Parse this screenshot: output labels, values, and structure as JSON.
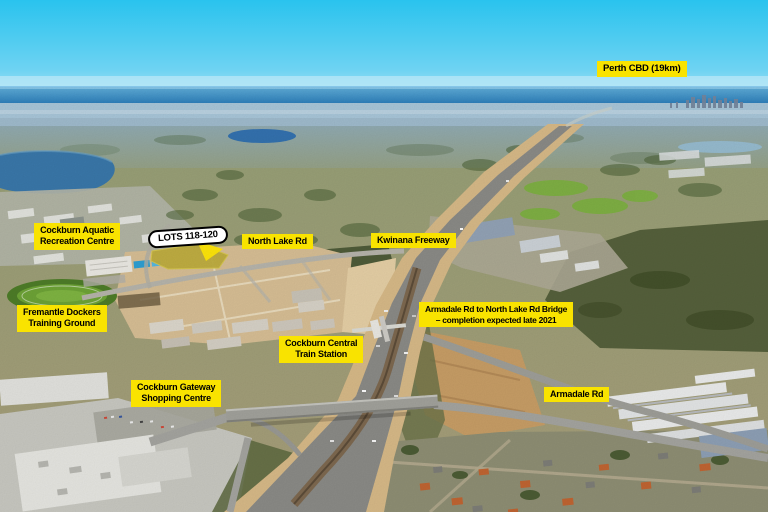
{
  "scene": {
    "description": "Aerial photograph over Cockburn Central and the Kwinana Freeway looking toward Perth CBD, with highlighted development lots",
    "colors": {
      "label_bg": "#F9E300",
      "label_text": "#000000",
      "lots_label_bg": "#FFFFFF",
      "lots_label_border": "#000000",
      "lot_highlight": "#BFAE3E",
      "pointer_arrow": "#FFE600",
      "sky": "#2AC4EE",
      "ocean": "#2E83C0"
    }
  },
  "labels": {
    "perth_cbd": "Perth CBD (19km)",
    "lots": "LOTS 118-120",
    "north_lake_rd": "North Lake Rd",
    "kwinana_freeway": "Kwinana Freeway",
    "aquatic": {
      "line1": "Cockburn Aquatic",
      "line2": "Recreation Centre"
    },
    "fremantle": {
      "line1": "Fremantle Dockers",
      "line2": "Training Ground"
    },
    "bridge": {
      "line1": "Armadale Rd to North Lake Rd Bridge",
      "line2": "– completion expected late 2021"
    },
    "station": {
      "line1": "Cockburn Central",
      "line2": "Train Station"
    },
    "gateway": {
      "line1": "Cockburn Gateway",
      "line2": "Shopping Centre"
    },
    "armadale_rd": "Armadale Rd"
  }
}
